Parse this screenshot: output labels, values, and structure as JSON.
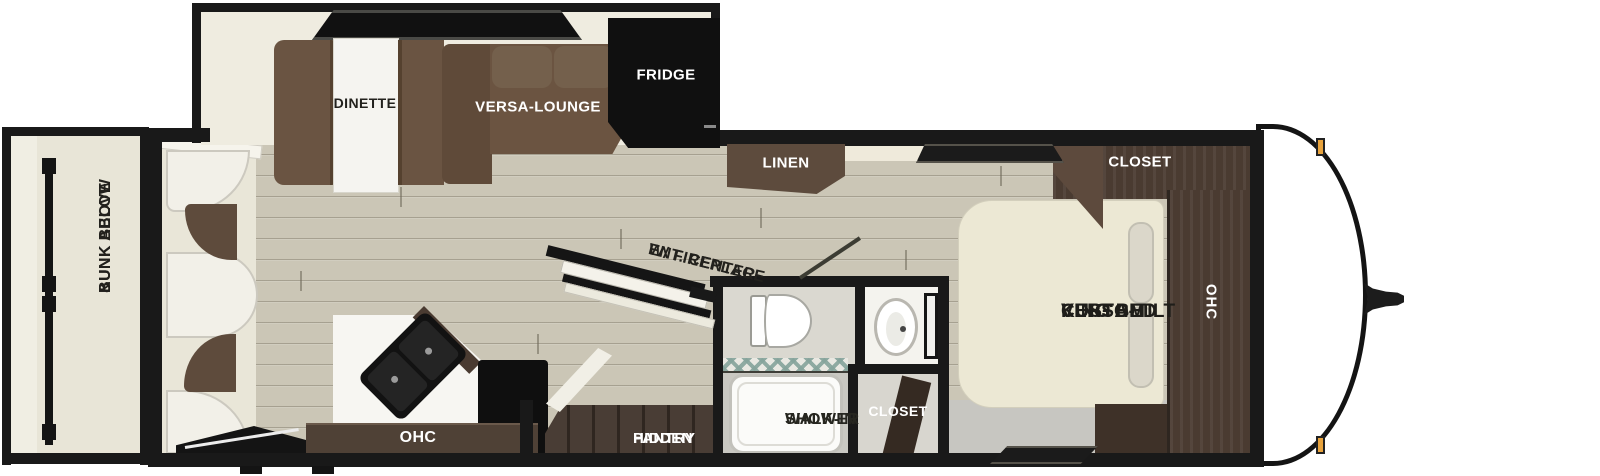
{
  "diagram_type": "rv-travel-trailer-floorplan",
  "labels": {
    "bunk": {
      "line1": "BUNK ABOVE",
      "line2": "&",
      "line3": "BUNK BELOW"
    },
    "dinette": "DINETTE",
    "versa_lounge": "VERSA-LOUNGE",
    "fridge": "FRIDGE",
    "linen": "LINEN",
    "ent_center": {
      "line1": "ENT. CENTER",
      "line2": "W/ FIREPLACE"
    },
    "ohc_kitchen": "OHC",
    "hidden_pantry": {
      "line1": "HIDDEN",
      "line2": "PANTRY"
    },
    "walk_in_shower": {
      "line1": "WALK-IN",
      "line2": "SHOWER"
    },
    "closet_bath": "CLOSET",
    "closet_bedroom": "CLOSET",
    "ohc_bedroom": "OHC",
    "king_bed": {
      "line1": "VERSA-TILT",
      "line2": "CUSTOM",
      "line3": "KING BED"
    }
  },
  "colors": {
    "wall": "#191919",
    "floor_wood": "#cbc6b6",
    "slide_floor": "#efece0",
    "sofa_brown": "#6b5441",
    "cabinet_walnut": "#4a3b31",
    "cabinet_dark": "#3e3128",
    "bed_cream": "#ece8d4",
    "bath_floor": "#dad8d0",
    "walkway_gray": "#c7c6c1",
    "marker_light_amber": "#e8a33d",
    "fridge_black": "#101010"
  }
}
